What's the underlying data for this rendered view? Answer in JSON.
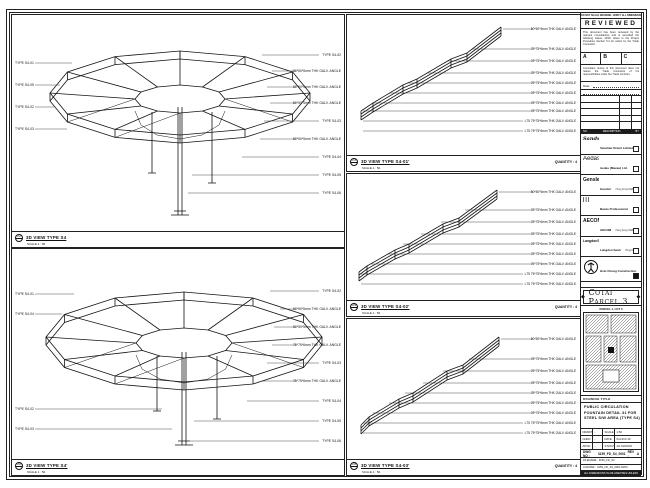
{
  "sheet": {
    "top_note": "DO NOT SCALE DRAWING. VERIFY ALL DIMENSIONS ON SITE.",
    "bottom_note": "ALL DIMENSIONS IN MILLIMETRES UNLESS OTHERWISE NOTED"
  },
  "stamp": {
    "header": "REVIEWED",
    "para1": "This document has been reviewed by the relevant consultant(s) and is accorded the following status, which refers to the Project Procedure Section 5.4 for action by the Trade Contractor.",
    "options": [
      "A",
      "B",
      "C"
    ],
    "para2": "Consultant review of this document does not relieve the Trade Contractor of his responsibilities under the Trade Contract.",
    "date_label": "Date :"
  },
  "revision_header": {
    "no": "NO.",
    "desc": "DESCRIPTION",
    "by": "BY"
  },
  "companies": [
    {
      "logo": "Sands",
      "name": "Venetian Orient Limited",
      "addr": "Estrada da Baia de N. Senhora, Macau SAR"
    },
    {
      "logo": "Aedas",
      "name": "Aedas (Macau) Ltd.",
      "addr": "Avenida da Praia Grande, Macau SAR"
    },
    {
      "logo": "Gensler",
      "name": "Gensler",
      "addr": "Hong Kong SAR"
    },
    {
      "logo": "|||",
      "name": "Bacas Professional Services Ltd.",
      "addr": "Macau SAR"
    },
    {
      "logo": "AECOM",
      "name": "AECOM",
      "addr": "Hong Kong SAR"
    },
    {
      "logo": "LangdonSeah",
      "name": "Langdon Seah",
      "addr": "Hong Kong SAR"
    }
  ],
  "contractor": {
    "name": "Hsin Chong Construction (Macau) Co. Ltd.",
    "addr": "Macau SAR"
  },
  "banner": {
    "text": "Cotai Parcel 3",
    "ornament": "◆"
  },
  "keyplan": {
    "header": "PARCEL 1, LOT 3"
  },
  "titleblock": {
    "header": "DRAWING TITLE",
    "line1": "PUBLIC CIRCULATION",
    "line2": "FOUNTAIN DETAIL 31 FOR",
    "line3": "STEEL S/W AREA (TYPE S4)",
    "fields": {
      "r1l": "DRAWN",
      "r1v": "-",
      "r1l2": "SCALE",
      "r1v2": "1:50",
      "r2l": "CHKD",
      "r2v": "-",
      "r2l2": "DATE",
      "r2v2": "04-NOV-10",
      "r3l": "APVD",
      "r3v": "-",
      "r3l2": "STATUS",
      "r3v2": "AS SHOWN"
    },
    "dwg_label": "DWG NO :",
    "dwg_no": "3159_FD_S4_0001",
    "rev_label": "REV :",
    "rev": "A",
    "filename_label": "FILENAME :",
    "filename": "3159_FD_S4",
    "ref": "CAD REF : 3159_FD_S4_0001.DWG"
  },
  "views": {
    "v1": {
      "bubble": "22",
      "title": "3D VIEW TYPE S4",
      "scale": "SCALE 1 : 50",
      "left_callouts": [
        "TYPE S4-01",
        "TYPE S4-05",
        "TYPE S4-02",
        "TYPE S4-03"
      ],
      "right_callouts": [
        "TYPE S4-02",
        "50*50*5mm THK GALV. ANGLE",
        "50*50*5mm THK GALV. ANGLE",
        "50*50*5mm THK GALV. ANGLE",
        "TYPE S4-03",
        "50*50*5mm THK GALV. ANGLE",
        "TYPE S4-04",
        "TYPE S4-05",
        "TYPE S4-06"
      ]
    },
    "v2": {
      "bubble": "26",
      "title": "3D VIEW TYPE S4'",
      "scale": "SCALE 1 : 50",
      "left_callouts": [
        "TYPE S4-01",
        "TYPE S4-04",
        "TYPE S4-02",
        "TYPE S4-03"
      ],
      "right_callouts": [
        "TYPE S4-02",
        "50*50*5mm THK GALV. ANGLE",
        "50*50*5mm THK GALV. ANGLE",
        "75*75*6mm THK GALV. ANGLE",
        "TYPE S4-03",
        "75*75*6mm THK GALV. ANGLE",
        "TYPE S4-04",
        "TYPE S4-05",
        "TYPE S4-06"
      ]
    },
    "d1": {
      "bubble": "23",
      "title": "3D VIEW TYPE S4-01'",
      "scale": "SCALE 1 : 50",
      "quantity": "QUANTITY : 4",
      "callouts": [
        "50*50*5mm THK GALV. ANGLE",
        "75*75*6mm THK GALV. ANGLE",
        "75*75*6mm THK GALV. ANGLE",
        "75*75*6mm THK GALV. ANGLE",
        "75*75*6mm THK GALV. ANGLE",
        "75*75*6mm THK GALV. ANGLE",
        "75*75*6mm THK GALV. ANGLE",
        "75*75*6mm THK GALV. ANGLE",
        "L75 75*75*6mm THK GALV. ANGLE",
        "L75 75*75*6mm THK GALV. ANGLE"
      ]
    },
    "d2": {
      "bubble": "24",
      "title": "3D VIEW TYPE S4-02'",
      "scale": "SCALE 1 : 50",
      "quantity": "QUANTITY : 4",
      "callouts": [
        "50*50*5mm THK GALV. ANGLE",
        "75*75*6mm THK GALV. ANGLE",
        "75*75*6mm THK GALV. ANGLE",
        "75*75*6mm THK GALV. ANGLE",
        "75*75*6mm THK GALV. ANGLE",
        "75*75*6mm THK GALV. ANGLE",
        "75*75*6mm THK GALV. ANGLE",
        "L75 75*75*6mm THK GALV. ANGLE",
        "L75 75*75*6mm THK GALV. ANGLE"
      ]
    },
    "d3": {
      "bubble": "25",
      "title": "3D VIEW TYPE S4-03'",
      "scale": "SCALE 1 : 50",
      "quantity": "QUANTITY : 4",
      "callouts": [
        "50*50*5mm THK GALV. ANGLE",
        "75*75*6mm THK GALV. ANGLE",
        "75*75*6mm THK GALV. ANGLE",
        "75*75*6mm THK GALV. ANGLE",
        "75*75*6mm THK GALV. ANGLE",
        "75*75*6mm THK GALV. ANGLE",
        "75*75*6mm THK GALV. ANGLE",
        "L75 75*75*6mm THK GALV. ANGLE",
        "L75 75*75*6mm THK GALV. ANGLE"
      ]
    }
  }
}
